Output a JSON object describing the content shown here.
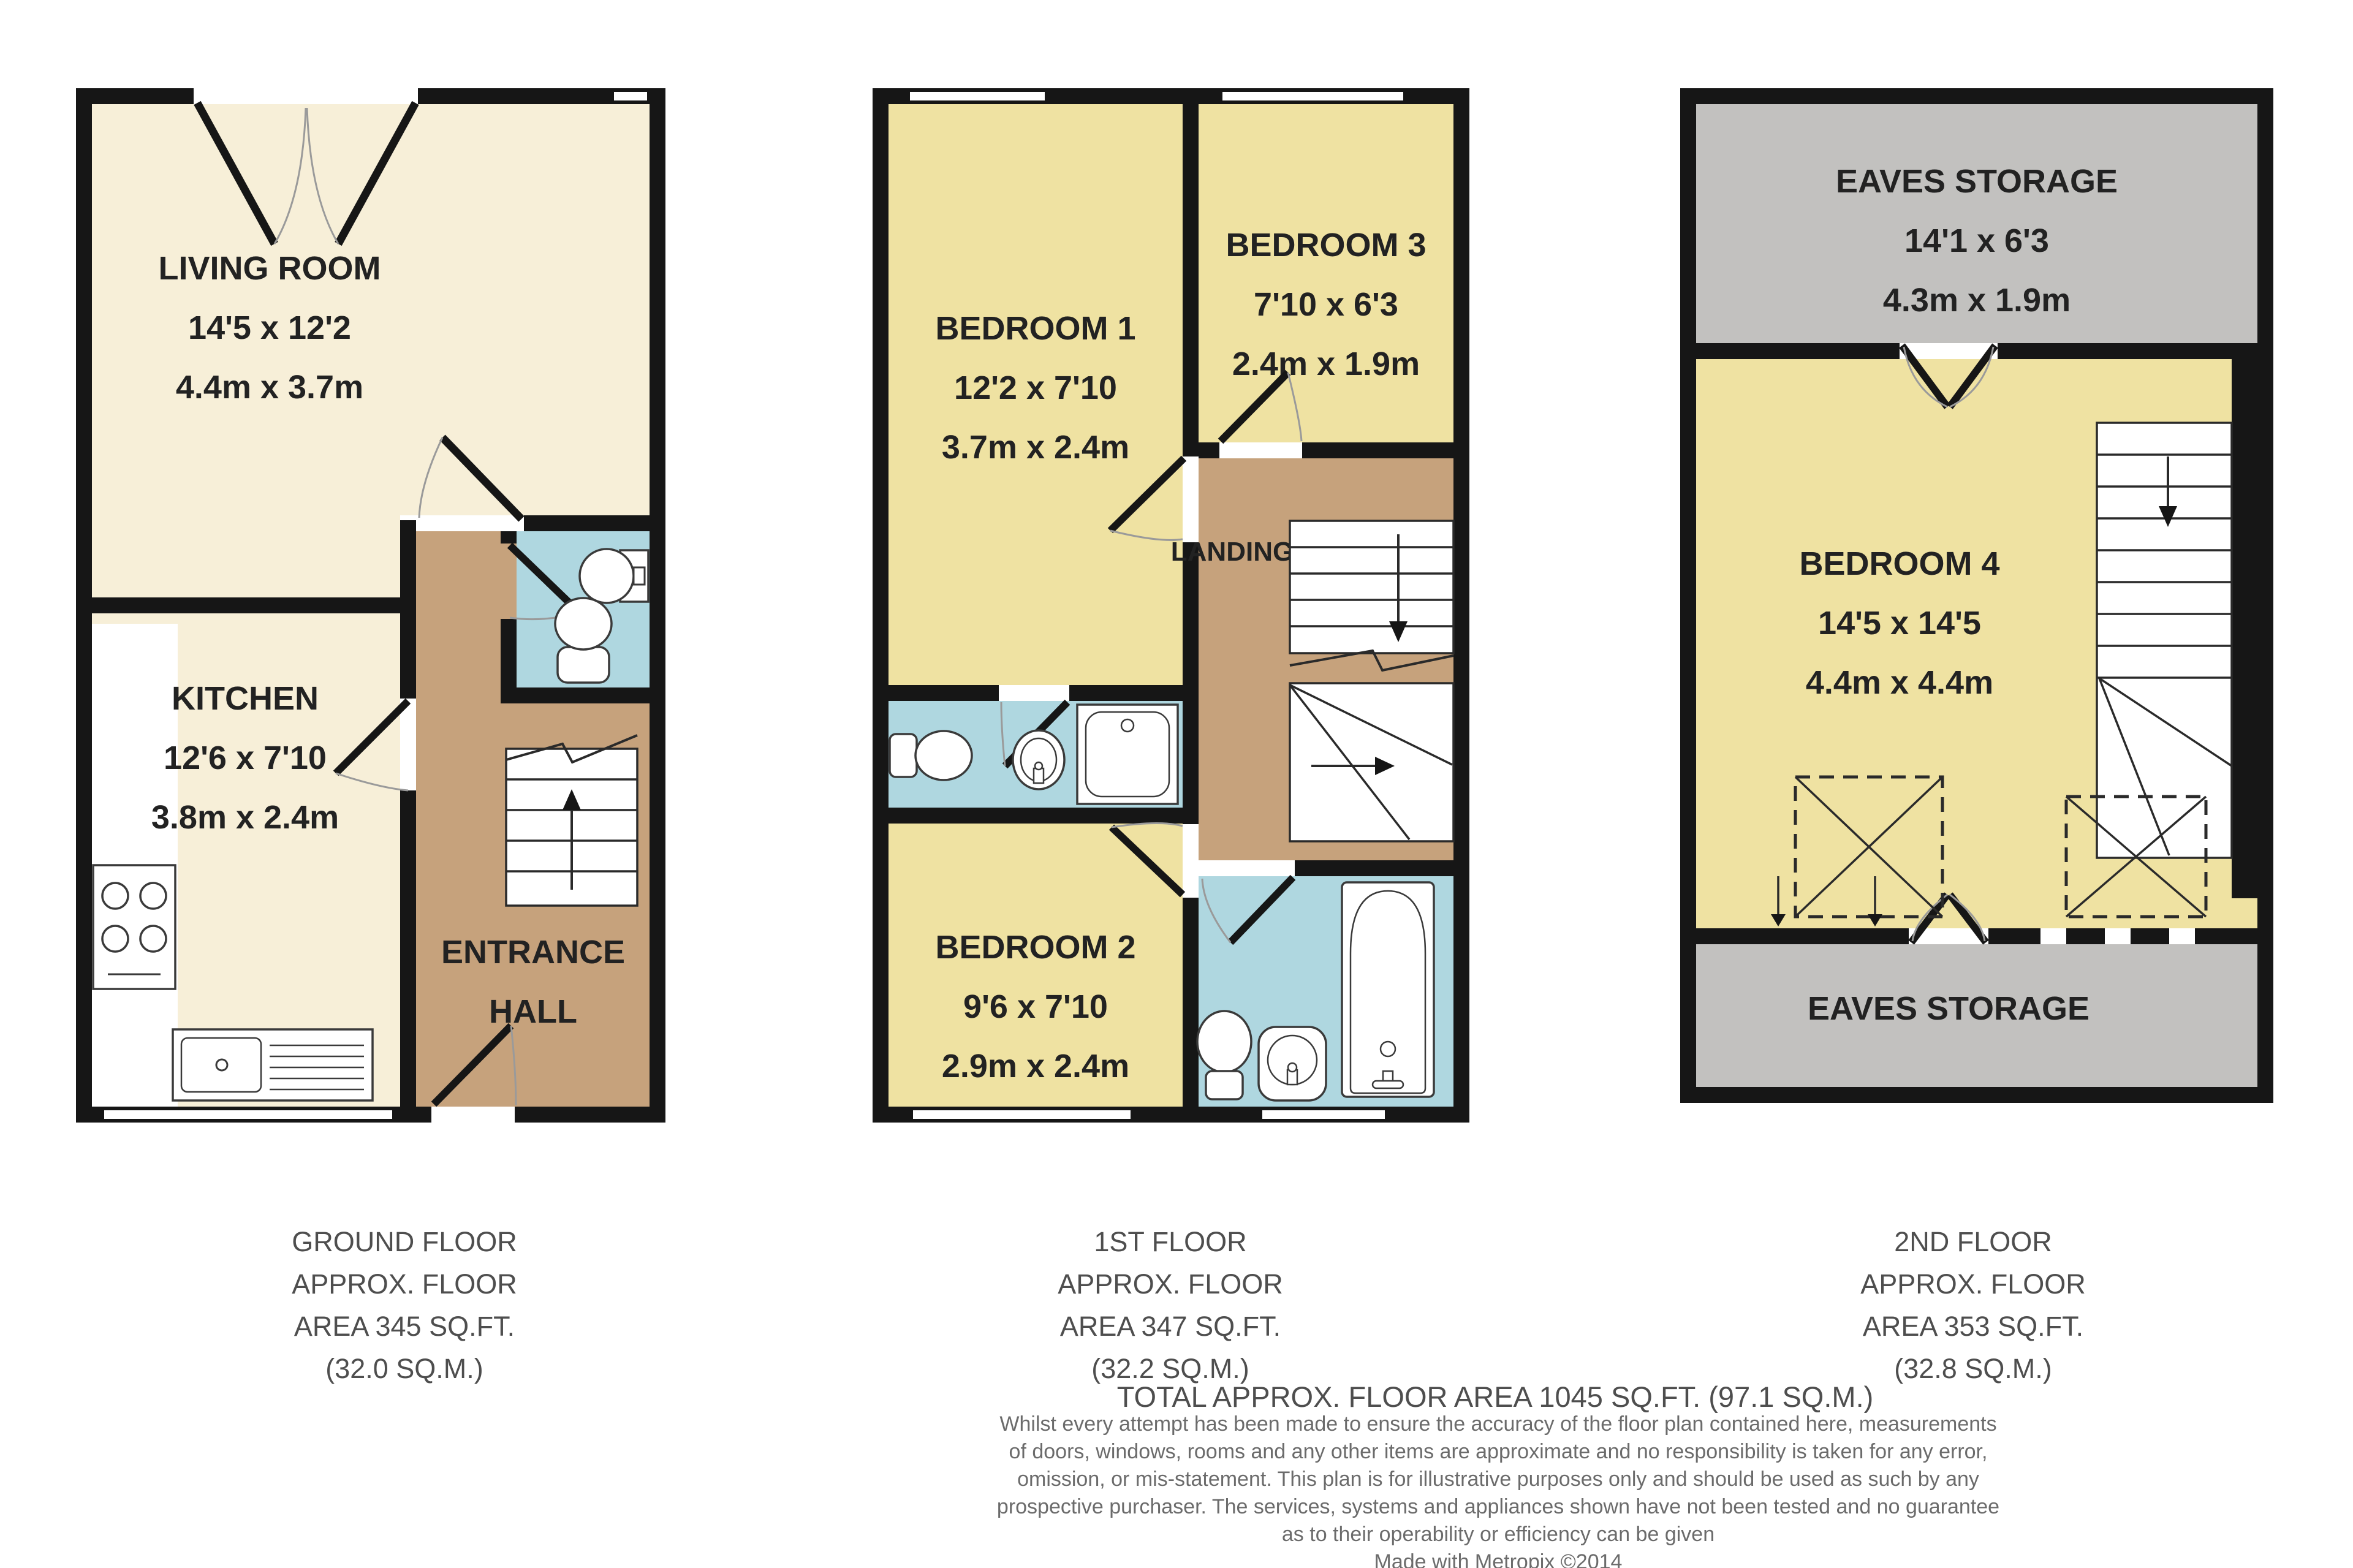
{
  "colors": {
    "wall": "#161616",
    "living_cream": "#F7EFD8",
    "bedroom_yellow": "#EFE2A2",
    "hall_tan": "#C6A27C",
    "bathroom_blue": "#AFD7E0",
    "eaves_grey": "#C2C1BF",
    "caption_grey": "#4e4e4e"
  },
  "floors": {
    "ground": {
      "caption": {
        "lines": [
          "GROUND FLOOR",
          "APPROX. FLOOR",
          "AREA 345 SQ.FT.",
          "(32.0 SQ.M.)"
        ]
      },
      "rooms": {
        "living": {
          "name": "LIVING ROOM",
          "dims_ft": "14'5 x 12'2",
          "dims_m": "4.4m x 3.7m"
        },
        "kitchen": {
          "name": "KITCHEN",
          "dims_ft": "12'6 x 7'10",
          "dims_m": "3.8m x 2.4m"
        },
        "entrance_hall": {
          "name_line1": "ENTRANCE",
          "name_line2": "HALL"
        }
      }
    },
    "first": {
      "caption": {
        "lines": [
          "1ST FLOOR",
          "APPROX. FLOOR",
          "AREA 347 SQ.FT.",
          "(32.2 SQ.M.)"
        ]
      },
      "rooms": {
        "bedroom1": {
          "name": "BEDROOM 1",
          "dims_ft": "12'2 x 7'10",
          "dims_m": "3.7m x 2.4m"
        },
        "bedroom3": {
          "name": "BEDROOM 3",
          "dims_ft": "7'10 x 6'3",
          "dims_m": "2.4m x 1.9m"
        },
        "bedroom2": {
          "name": "BEDROOM 2",
          "dims_ft": "9'6 x 7'10",
          "dims_m": "2.9m x 2.4m"
        },
        "landing": {
          "name": "LANDING"
        }
      }
    },
    "second": {
      "caption": {
        "lines": [
          "2ND FLOOR",
          "APPROX. FLOOR",
          "AREA 353 SQ.FT.",
          "(32.8 SQ.M.)"
        ]
      },
      "rooms": {
        "eaves_top": {
          "name": "EAVES STORAGE",
          "dims_ft": "14'1 x 6'3",
          "dims_m": "4.3m x 1.9m"
        },
        "bedroom4": {
          "name": "BEDROOM 4",
          "dims_ft": "14'5 x 14'5",
          "dims_m": "4.4m x 4.4m"
        },
        "eaves_bottom": {
          "name": "EAVES STORAGE"
        }
      }
    }
  },
  "summary": {
    "total": "TOTAL APPROX. FLOOR AREA 1045 SQ.FT. (97.1 SQ.M.)",
    "disclaimer_lines": [
      "Whilst every attempt has been made to ensure the accuracy of the floor plan contained here, measurements",
      "of doors, windows, rooms and any other items are approximate and no responsibility is taken for any error,",
      "omission, or mis-statement. This plan is for illustrative purposes only and should be used as such by any",
      "prospective purchaser. The services, systems and appliances shown have not been tested and no guarantee",
      "as to their operability or efficiency can be given"
    ],
    "credit": "Made with Metropix ©2014"
  }
}
